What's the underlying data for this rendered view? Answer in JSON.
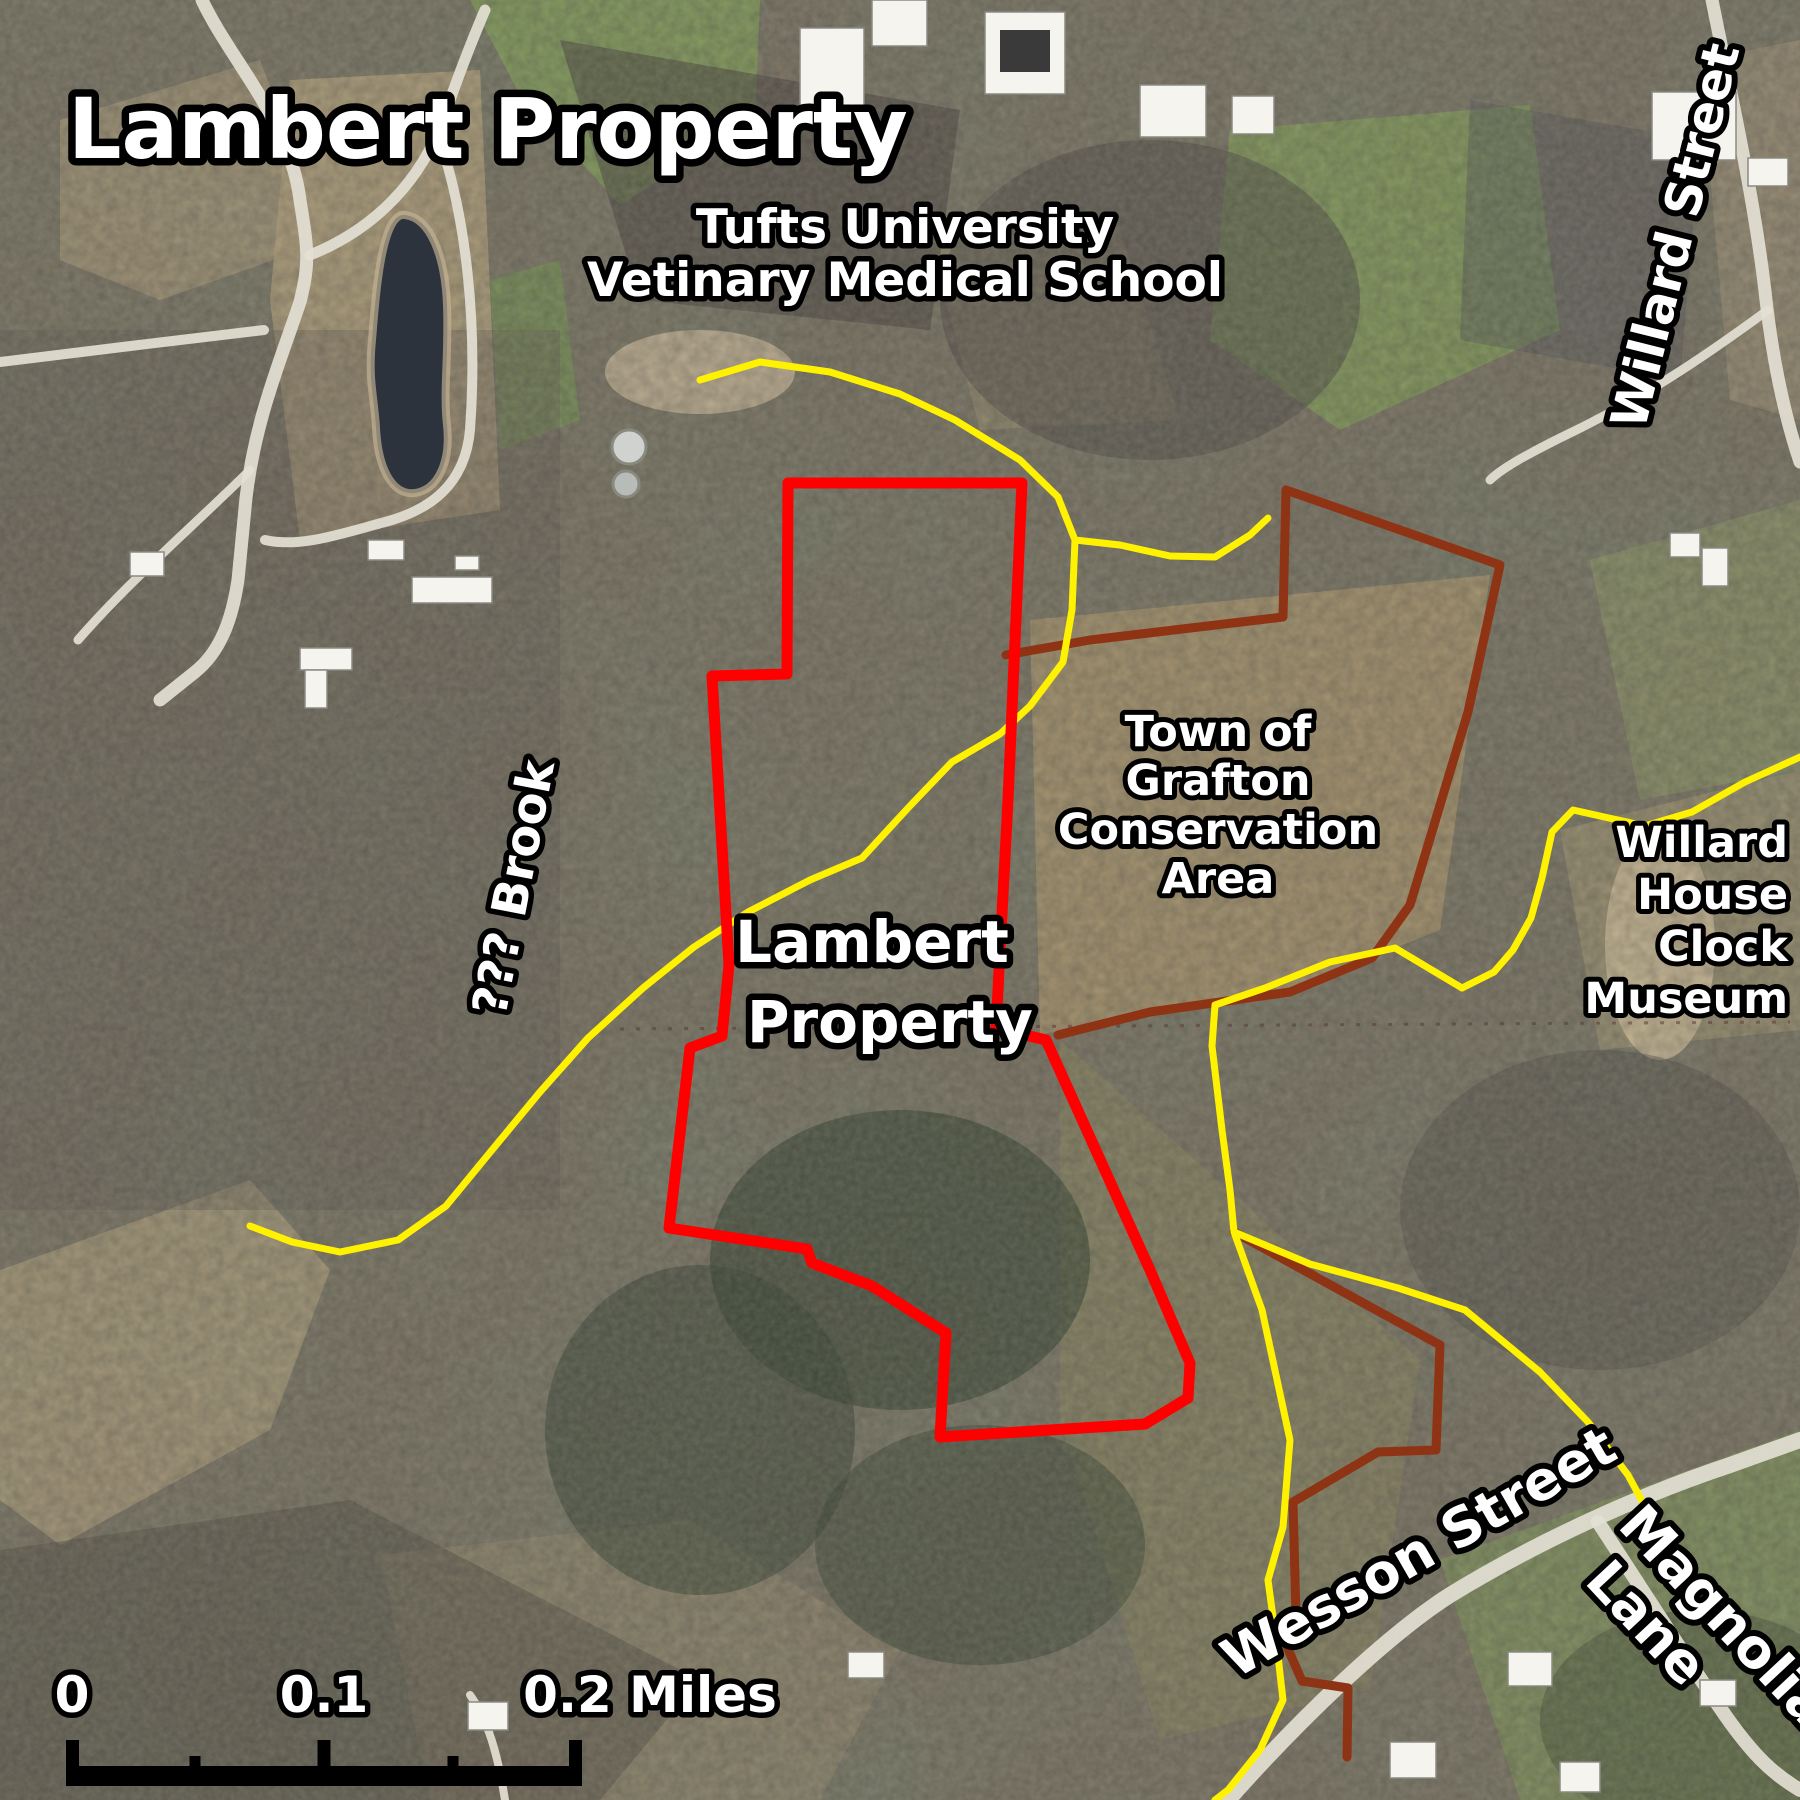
{
  "map": {
    "title": "Lambert Property",
    "labels": {
      "tufts_line1": "Tufts University",
      "tufts_line2": "Vetinary Medical School",
      "willard_street": "Willard Street",
      "brook": "??? Brook",
      "property_line1": "Lambert",
      "property_line2": "Property",
      "grafton_line1": "Town of",
      "grafton_line2": "Grafton",
      "grafton_line3": "Conservation",
      "grafton_line4": "Area",
      "museum_line1": "Willard",
      "museum_line2": "House",
      "museum_line3": "Clock",
      "museum_line4": "Museum",
      "wesson_street": "Wesson Street",
      "magnolia_line1": "Magnolia",
      "magnolia_line2": "Lane"
    },
    "scale_bar": {
      "label_0": "0",
      "label_01": "0.1",
      "label_02": "0.2 Miles"
    },
    "colors": {
      "property_boundary": "#ff0000",
      "conservation_boundary": "#8e3415",
      "trail": "#fff200",
      "label_fill": "#ffffff",
      "label_outline": "#000000"
    }
  }
}
